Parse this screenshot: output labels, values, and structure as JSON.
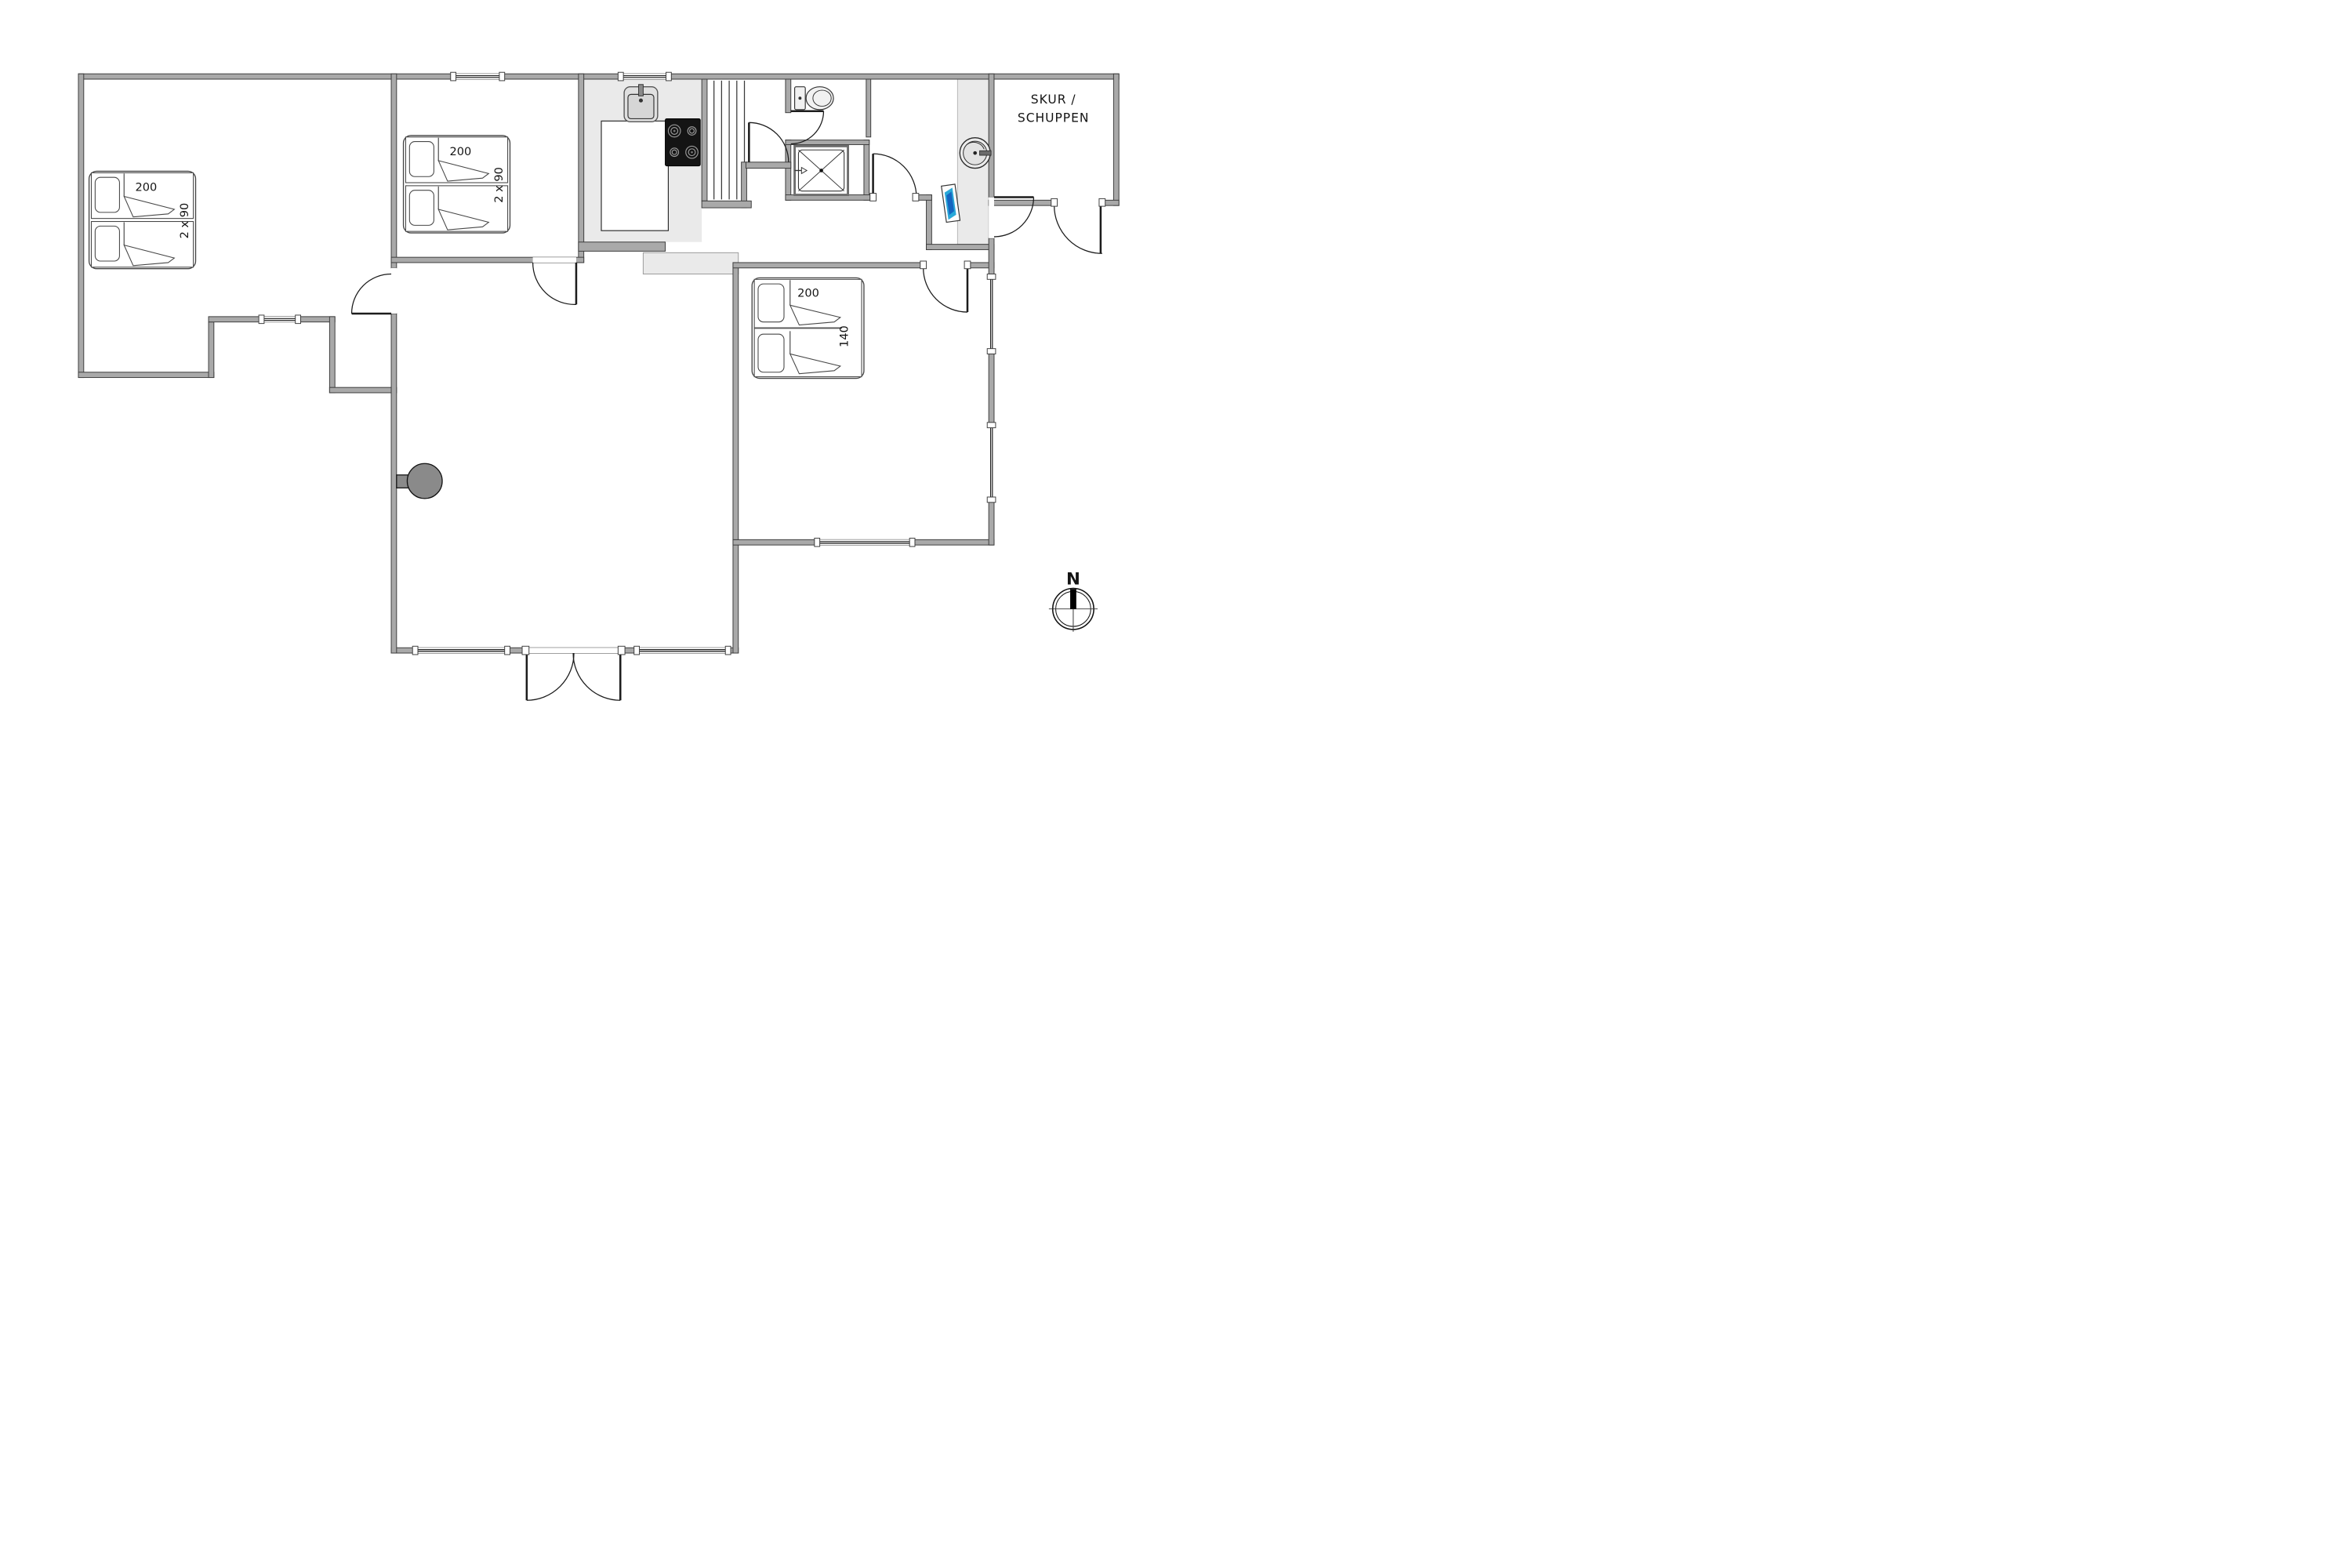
{
  "plan_type": "holiday-house-floor-plan",
  "colors": {
    "wall_fill": "#a9a9a9",
    "wall_stroke": "#3c3c3c",
    "floor_light": "#eaeaea",
    "line": "#1c1c1c",
    "stove_black": "#141414",
    "washer_accent": "#28a8d8",
    "fireplace_gray": "#8a8a8a"
  },
  "labels": {
    "shed_line1": "SKUR /",
    "shed_line2": "SCHUPPEN",
    "compass_north": "N",
    "bedroom1_bed_length": "200",
    "bedroom1_bed_width": "2 x 90",
    "bedroom2_bed_length": "200",
    "bedroom2_bed_width": "2 x 90",
    "bedroom3_bed_length": "200",
    "bedroom3_bed_width": "140"
  },
  "rooms": [
    {
      "name": "bedroom-1",
      "beds": "2 single beds 200 x 2x90"
    },
    {
      "name": "bedroom-2",
      "beds": "2 single beds 200 x 2x90"
    },
    {
      "name": "bedroom-3",
      "beds": "double bed 200 x 140"
    },
    {
      "name": "kitchen",
      "fixtures": [
        "sink",
        "stove",
        "island-counter"
      ]
    },
    {
      "name": "sauna",
      "feature": "plank benches"
    },
    {
      "name": "wc",
      "fixtures": [
        "toilet"
      ]
    },
    {
      "name": "shower-room",
      "fixtures": [
        "shower-tray"
      ]
    },
    {
      "name": "entry-hall",
      "fixtures": [
        "washbasin",
        "washer"
      ]
    },
    {
      "name": "living-room",
      "fixtures": [
        "wood-stove-fireplace",
        "french-entrance-doors"
      ]
    },
    {
      "name": "shed",
      "label": "SKUR / SCHUPPEN"
    }
  ]
}
